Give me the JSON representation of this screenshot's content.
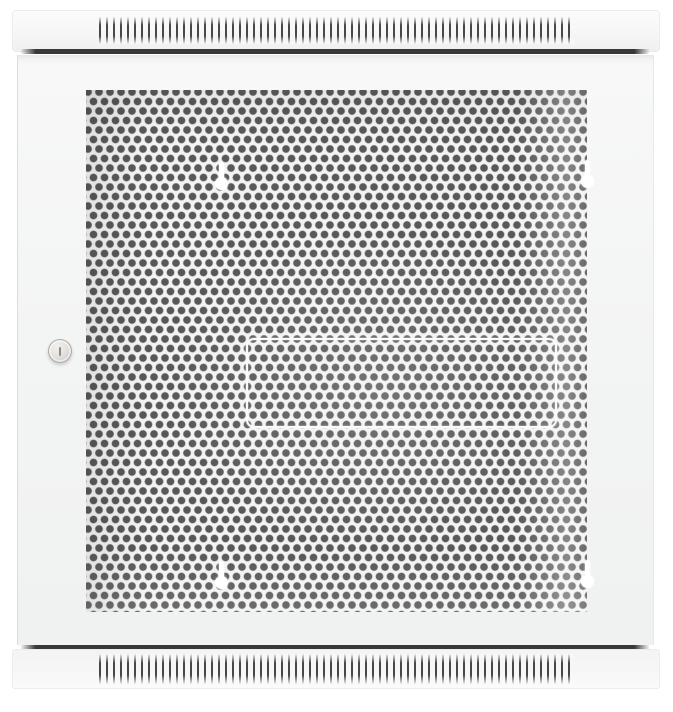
{
  "scene": {
    "subject": "Wall-mount network server cabinet, front view, closed perforated mesh door",
    "text_content": "none"
  },
  "cabinet": {
    "top_vent_cap": "horizontal cap with vertical ventilation slits",
    "bottom_vent_cap": "horizontal cap with vertical ventilation slits",
    "door": "full-front perforated mesh door",
    "mounting_keyholes_count": 4,
    "lock": "round cylinder lock with vertical key slot",
    "plate_outline": "stamped rounded-rectangle outline centered in mesh"
  },
  "colors": {
    "page_bg": "#ffffff",
    "cap": "#f6f6f6",
    "cap_edge": "#ececec",
    "door": "#f3f4f4",
    "door_edge": "#dcdcdc",
    "shadow_line": "#383838",
    "mesh_panel": "#f3f3f3",
    "mesh_hole": "#585858",
    "slit": "#474747",
    "keyhole": "#ffffff",
    "plate_outline": "#fafafa",
    "lock_ring": "#b7b5b1",
    "lock_face": "#e4e2dd",
    "lock_slot": "#8b8b8b"
  }
}
